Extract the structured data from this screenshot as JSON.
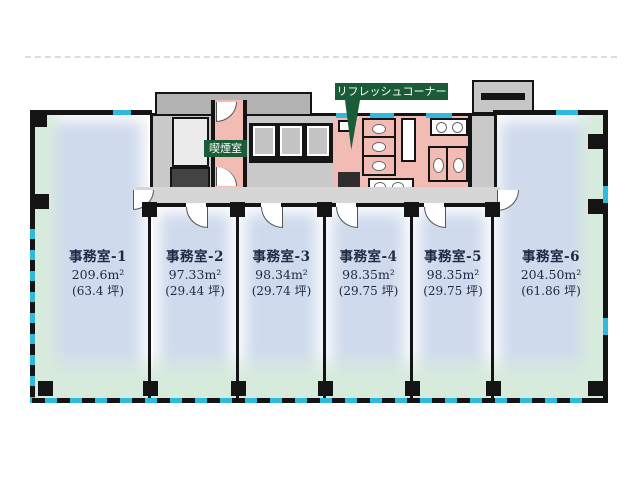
{
  "rooms": [
    {
      "name": "事務室-1",
      "area": "209.6m²",
      "tsubo": "(63.4 坪)"
    },
    {
      "name": "事務室-2",
      "area": "97.33m²",
      "tsubo": "(29.44 坪)"
    },
    {
      "name": "事務室-3",
      "area": "98.34m²",
      "tsubo": "(29.74 坪)"
    },
    {
      "name": "事務室-4",
      "area": "98.35m²",
      "tsubo": "(29.75 坪)"
    },
    {
      "name": "事務室-5",
      "area": "98.35m²",
      "tsubo": "(29.75 坪)"
    },
    {
      "name": "事務室-6",
      "area": "204.50m²",
      "tsubo": "(61.86 坪)"
    }
  ],
  "callouts": {
    "refresh_corner": "リフレッシュコーナー",
    "smoking_room": "喫煙室"
  },
  "colors": {
    "office_fill": "#cfdaed",
    "perimeter_green": "#d7ebdc",
    "core_gray": "#c9c9c9",
    "wet_area_pink": "#f2bcb4",
    "window_cyan": "#2fb9dc",
    "callout_green": "#1a5c38",
    "wall_black": "#141414",
    "label_text": "#1e2a44"
  }
}
